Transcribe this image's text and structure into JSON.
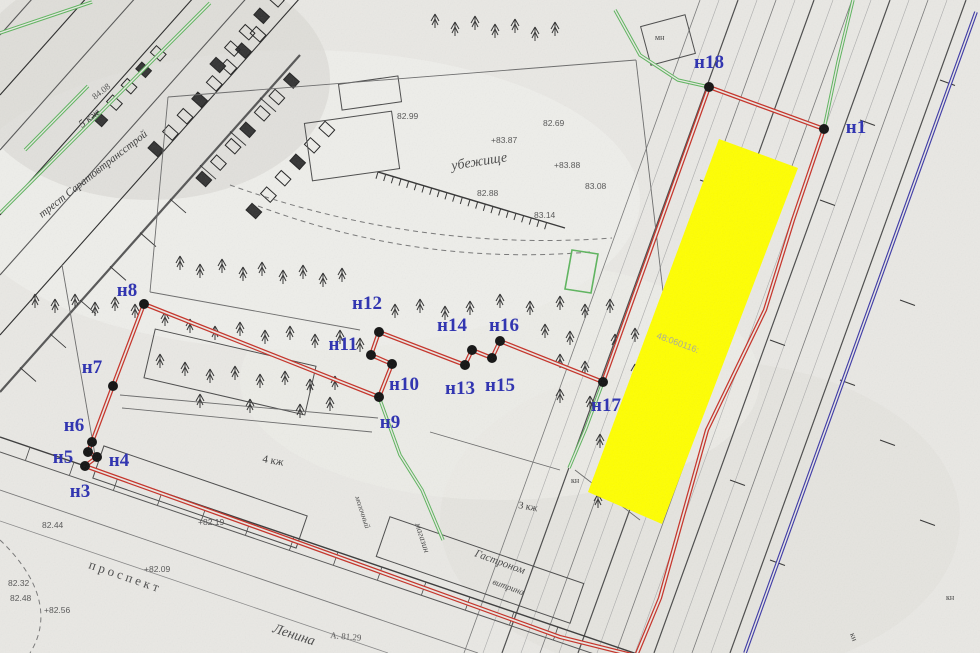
{
  "map_kind": "cadastral survey plan (scanned)",
  "colors": {
    "paper": "#e9e8e4",
    "boundary_red": "#c63026",
    "parcel_yellow": "#ffff00",
    "point_label_blue": "#2b2fb0",
    "utility_green": "#5cb45c",
    "axis_blue": "#3c38a6",
    "ink": "#3a3a3a"
  },
  "points": [
    {
      "id": "н1",
      "x": 824,
      "y": 129,
      "lx": 856,
      "ly": 133
    },
    {
      "id": "н3",
      "x": 85,
      "y": 466,
      "lx": 80,
      "ly": 497
    },
    {
      "id": "н4",
      "x": 97,
      "y": 457,
      "lx": 119,
      "ly": 466
    },
    {
      "id": "н5",
      "x": 88,
      "y": 452,
      "lx": 63,
      "ly": 463
    },
    {
      "id": "н6",
      "x": 92,
      "y": 442,
      "lx": 74,
      "ly": 431
    },
    {
      "id": "н7",
      "x": 113,
      "y": 386,
      "lx": 92,
      "ly": 373
    },
    {
      "id": "н8",
      "x": 144,
      "y": 304,
      "lx": 127,
      "ly": 296
    },
    {
      "id": "н9",
      "x": 379,
      "y": 397,
      "lx": 390,
      "ly": 428
    },
    {
      "id": "н10",
      "x": 392,
      "y": 364,
      "lx": 404,
      "ly": 390
    },
    {
      "id": "н11",
      "x": 371,
      "y": 355,
      "lx": 343,
      "ly": 350
    },
    {
      "id": "н12",
      "x": 379,
      "y": 332,
      "lx": 367,
      "ly": 309
    },
    {
      "id": "н13",
      "x": 465,
      "y": 365,
      "lx": 460,
      "ly": 394
    },
    {
      "id": "н14",
      "x": 472,
      "y": 350,
      "lx": 452,
      "ly": 331
    },
    {
      "id": "н15",
      "x": 492,
      "y": 358,
      "lx": 500,
      "ly": 391
    },
    {
      "id": "н16",
      "x": 500,
      "y": 341,
      "lx": 504,
      "ly": 331
    },
    {
      "id": "н17",
      "x": 603,
      "y": 382,
      "lx": 606,
      "ly": 411
    },
    {
      "id": "н18",
      "x": 709,
      "y": 87,
      "lx": 709,
      "ly": 68
    }
  ],
  "boundary": [
    [
      85,
      466
    ],
    [
      300,
      543
    ],
    [
      560,
      637
    ],
    [
      636,
      656
    ],
    [
      660,
      598
    ],
    [
      707,
      430
    ],
    [
      765,
      310
    ],
    [
      793,
      220
    ],
    [
      824,
      129
    ],
    [
      709,
      87
    ],
    [
      603,
      382
    ],
    [
      500,
      341
    ],
    [
      492,
      358
    ],
    [
      472,
      350
    ],
    [
      465,
      365
    ],
    [
      379,
      332
    ],
    [
      371,
      355
    ],
    [
      392,
      364
    ],
    [
      379,
      397
    ],
    [
      144,
      304
    ],
    [
      113,
      386
    ],
    [
      92,
      442
    ],
    [
      88,
      452
    ],
    [
      97,
      457
    ],
    [
      85,
      466
    ]
  ],
  "yellow_parcel": {
    "corners": [
      [
        719,
        139
      ],
      [
        798,
        168
      ],
      [
        662,
        524
      ],
      [
        588,
        492
      ]
    ],
    "cadastral_text": {
      "text": "48:060116:",
      "x": 656,
      "y": 338,
      "rot": 20
    }
  },
  "blue_line": [
    [
      976,
      12
    ],
    [
      745,
      653
    ]
  ],
  "green_lines": [
    {
      "pts": [
        [
          0,
          33
        ],
        [
          92,
          2
        ]
      ]
    },
    {
      "pts": [
        [
          0,
          213
        ],
        [
          210,
          3
        ]
      ]
    },
    {
      "pts": [
        [
          25,
          150
        ],
        [
          88,
          86
        ]
      ]
    },
    {
      "pts": [
        [
          615,
          10
        ],
        [
          640,
          55
        ],
        [
          678,
          80
        ],
        [
          709,
          87
        ]
      ]
    },
    {
      "pts": [
        [
          853,
          0
        ],
        [
          838,
          62
        ],
        [
          824,
          129
        ]
      ]
    },
    {
      "pts": [
        [
          603,
          382
        ],
        [
          586,
          428
        ],
        [
          569,
          468
        ]
      ]
    },
    {
      "pts": [
        [
          379,
          397
        ],
        [
          400,
          455
        ],
        [
          422,
          490
        ],
        [
          443,
          540
        ]
      ]
    }
  ],
  "green_rect": [
    [
      572,
      250
    ],
    [
      598,
      254
    ],
    [
      591,
      293
    ],
    [
      565,
      289
    ]
  ],
  "map_texts": [
    {
      "text": "трест  Саратовтрансстрой",
      "x": 42,
      "y": 218,
      "rot": -38,
      "size": 11,
      "italic": true,
      "color": "#3a3a3a"
    },
    {
      "text": "5 кж",
      "x": 82,
      "y": 128,
      "rot": -38,
      "size": 11,
      "italic": true,
      "color": "#3a3a3a"
    },
    {
      "text": "84.08",
      "x": 95,
      "y": 100,
      "rot": -38,
      "size": 9,
      "italic": false,
      "color": "#555555"
    },
    {
      "text": "убежище",
      "x": 452,
      "y": 170,
      "rot": -9,
      "size": 14,
      "italic": true,
      "color": "#4a4a4a"
    },
    {
      "text": "п р о с п е к т",
      "x": 88,
      "y": 568,
      "rot": 19,
      "size": 13,
      "italic": false,
      "color": "#4a4a4a"
    },
    {
      "text": "Ленина",
      "x": 272,
      "y": 632,
      "rot": 18,
      "size": 14,
      "italic": true,
      "color": "#4a4a4a"
    },
    {
      "text": "А. 81.29",
      "x": 330,
      "y": 638,
      "rot": 5,
      "size": 9,
      "italic": false,
      "color": "#555555"
    },
    {
      "text": "4 кж",
      "x": 262,
      "y": 462,
      "rot": 10,
      "size": 11,
      "italic": false,
      "color": "#3a3a3a"
    },
    {
      "text": "3 кж",
      "x": 518,
      "y": 508,
      "rot": 10,
      "size": 10,
      "italic": false,
      "color": "#3a3a3a"
    },
    {
      "text": "магазин",
      "x": 415,
      "y": 524,
      "rot": 72,
      "size": 9,
      "italic": true,
      "color": "#4a4a4a"
    },
    {
      "text": "молочный",
      "x": 355,
      "y": 497,
      "rot": 72,
      "size": 8,
      "italic": true,
      "color": "#4a4a4a"
    },
    {
      "text": "Гастроном",
      "x": 474,
      "y": 556,
      "rot": 20,
      "size": 11,
      "italic": true,
      "color": "#4a4a4a"
    },
    {
      "text": "витрина",
      "x": 492,
      "y": 584,
      "rot": 20,
      "size": 9,
      "italic": true,
      "color": "#4a4a4a"
    },
    {
      "text": "кн",
      "x": 946,
      "y": 600,
      "rot": 0,
      "size": 8,
      "italic": false,
      "color": "#3a3a3a"
    },
    {
      "text": "кн",
      "x": 850,
      "y": 634,
      "rot": 70,
      "size": 8,
      "italic": false,
      "color": "#3a3a3a"
    },
    {
      "text": "кн",
      "x": 571,
      "y": 483,
      "rot": 0,
      "size": 8,
      "italic": false,
      "color": "#3a3a3a"
    },
    {
      "text": "мн",
      "x": 655,
      "y": 40,
      "rot": 0,
      "size": 8,
      "italic": false,
      "color": "#3a3a3a"
    }
  ],
  "elevations": [
    {
      "text": "82.99",
      "x": 397,
      "y": 119
    },
    {
      "text": "82.69",
      "x": 543,
      "y": 126
    },
    {
      "text": "+83.87",
      "x": 491,
      "y": 143
    },
    {
      "text": "+83.88",
      "x": 554,
      "y": 168
    },
    {
      "text": "83.08",
      "x": 585,
      "y": 189
    },
    {
      "text": "82.88",
      "x": 477,
      "y": 196
    },
    {
      "text": "83.14",
      "x": 534,
      "y": 218
    },
    {
      "text": "82.44",
      "x": 42,
      "y": 528
    },
    {
      "text": "82.32",
      "x": 8,
      "y": 586
    },
    {
      "text": "82.48",
      "x": 10,
      "y": 601
    },
    {
      "text": "+82.56",
      "x": 44,
      "y": 613
    },
    {
      "text": "+82.09",
      "x": 144,
      "y": 572
    },
    {
      "text": "+82.19",
      "x": 198,
      "y": 525
    }
  ]
}
